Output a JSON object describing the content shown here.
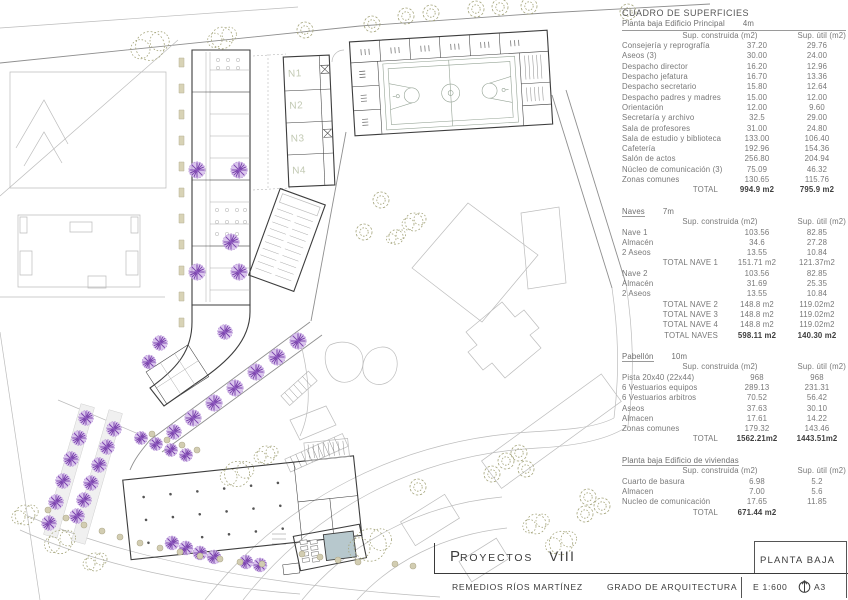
{
  "surface_table": {
    "title": "CUADRO DE SUPERFICIES",
    "columns": {
      "c1": "Sup. construida (m2)",
      "c2": "Sup. útil (m2)"
    },
    "sections": [
      {
        "heading": "Planta baja Edificio Principal",
        "size": "4m",
        "underline": "full",
        "rows": [
          {
            "label": "Consejería y reprografía",
            "c1": "37.20",
            "c2": "29.76"
          },
          {
            "label": "Aseos (3)",
            "c1": "30.00",
            "c2": "24.00"
          },
          {
            "label": "Despacho director",
            "c1": "16.20",
            "c2": "12.96"
          },
          {
            "label": "Despacho jefatura",
            "c1": "16.70",
            "c2": "13.36"
          },
          {
            "label": "Despacho secretario",
            "c1": "15.80",
            "c2": "12.64"
          },
          {
            "label": "Despacho padres y madres",
            "c1": "15.00",
            "c2": "12.00"
          },
          {
            "label": "Orientación",
            "c1": "12.00",
            "c2": "9.60"
          },
          {
            "label": "Secretaría y archivo",
            "c1": "32.5",
            "c2": "29.00"
          },
          {
            "label": "Sala de profesores",
            "c1": "31.00",
            "c2": "24.80"
          },
          {
            "label": "Sala de estudio y biblioteca",
            "c1": "133.00",
            "c2": "106.40"
          },
          {
            "label": "Cafetería",
            "c1": "192.96",
            "c2": "154.36"
          },
          {
            "label": "Salón de actos",
            "c1": "256.80",
            "c2": "204.94"
          },
          {
            "label": "Núcleo de comunicación (3)",
            "c1": "75.09",
            "c2": "46.32"
          },
          {
            "label": "Zonas comunes",
            "c1": "130.65",
            "c2": "115.76"
          },
          {
            "label": "TOTAL",
            "c1": "994.9 m2",
            "c2": "795.9 m2",
            "total": true,
            "bold": true
          }
        ]
      },
      {
        "heading": "Naves",
        "size": "7m",
        "underline": "word",
        "rows": [
          {
            "label": "Nave 1",
            "c1": "103.56",
            "c2": "82.85"
          },
          {
            "label": "Almacén",
            "c1": "34.6",
            "c2": "27.28"
          },
          {
            "label": "2 Aseos",
            "c1": "13.55",
            "c2": "10.84"
          },
          {
            "label": "TOTAL NAVE 1",
            "c1": "151.71 m2",
            "c2": "121.37m2",
            "total": true
          },
          {
            "label": "Nave 2",
            "c1": "103.56",
            "c2": "82.85"
          },
          {
            "label": "Almacén",
            "c1": "31.69",
            "c2": "25.35"
          },
          {
            "label": "2 Aseos",
            "c1": "13.55",
            "c2": "10.84"
          },
          {
            "label": "TOTAL NAVE 2",
            "c1": "148.8 m2",
            "c2": "119.02m2",
            "total": true
          },
          {
            "label": "TOTAL NAVE 3",
            "c1": "148.8 m2",
            "c2": "119.02m2",
            "total": true
          },
          {
            "label": "TOTAL NAVE 4",
            "c1": "148.8 m2",
            "c2": "119.02m2",
            "total": true
          },
          {
            "label": "TOTAL NAVES",
            "c1": "598.11 m2",
            "c2": "140.30 m2",
            "total": true,
            "bold": true
          }
        ]
      },
      {
        "heading": "Pabellón",
        "size": "10m",
        "underline": "word",
        "rows": [
          {
            "label": "Pista 20x40 (22x44)",
            "c1": "968",
            "c2": "968"
          },
          {
            "label": "6 Vestuarios equipos",
            "c1": "289.13",
            "c2": "231.31"
          },
          {
            "label": "6 Vestuarios arbitros",
            "c1": "70.52",
            "c2": "56.42"
          },
          {
            "label": "Aseos",
            "c1": "37.63",
            "c2": "30.10"
          },
          {
            "label": "Almacen",
            "c1": "17.61",
            "c2": "14.22"
          },
          {
            "label": "Zonas comunes",
            "c1": "179.32",
            "c2": "143.46"
          },
          {
            "label": "TOTAL",
            "c1": "1562.21m2",
            "c2": "1443.51m2",
            "total": true,
            "bold": true
          }
        ]
      },
      {
        "heading": "Planta baja Edificio de viviendas",
        "size": "",
        "underline": "word",
        "rows": [
          {
            "label": "Cuarto de basura",
            "c1": "6.98",
            "c2": "5.2"
          },
          {
            "label": "Almacen",
            "c1": "7.00",
            "c2": "5.6"
          },
          {
            "label": "Nucleo de comunicación",
            "c1": "17.65",
            "c2": "11.85"
          },
          {
            "label": "TOTAL",
            "c1": "671.44 m2",
            "c2": "",
            "total": true,
            "bold": true
          }
        ]
      }
    ]
  },
  "plan": {
    "nave_labels": [
      "N1",
      "N2",
      "N3",
      "N4"
    ]
  },
  "title_block": {
    "project_prefix": "P",
    "project_rest": "ROYECTOS",
    "project_number": "VIII",
    "sheet_name": "PLANTA BAJA",
    "author": "REMEDIOS RÍOS MARTÍNEZ",
    "course": "GRADO DE ARQUITECTURA",
    "scale": "E 1:600",
    "paper_size": "A3"
  },
  "colors": {
    "tree_purple_fill": "#d4bbea",
    "tree_purple_stroke": "#7b44ad",
    "tree_olive": "#a4a47a",
    "pool_water": "#b7c8cd",
    "line_dark": "#3d3d3d"
  }
}
